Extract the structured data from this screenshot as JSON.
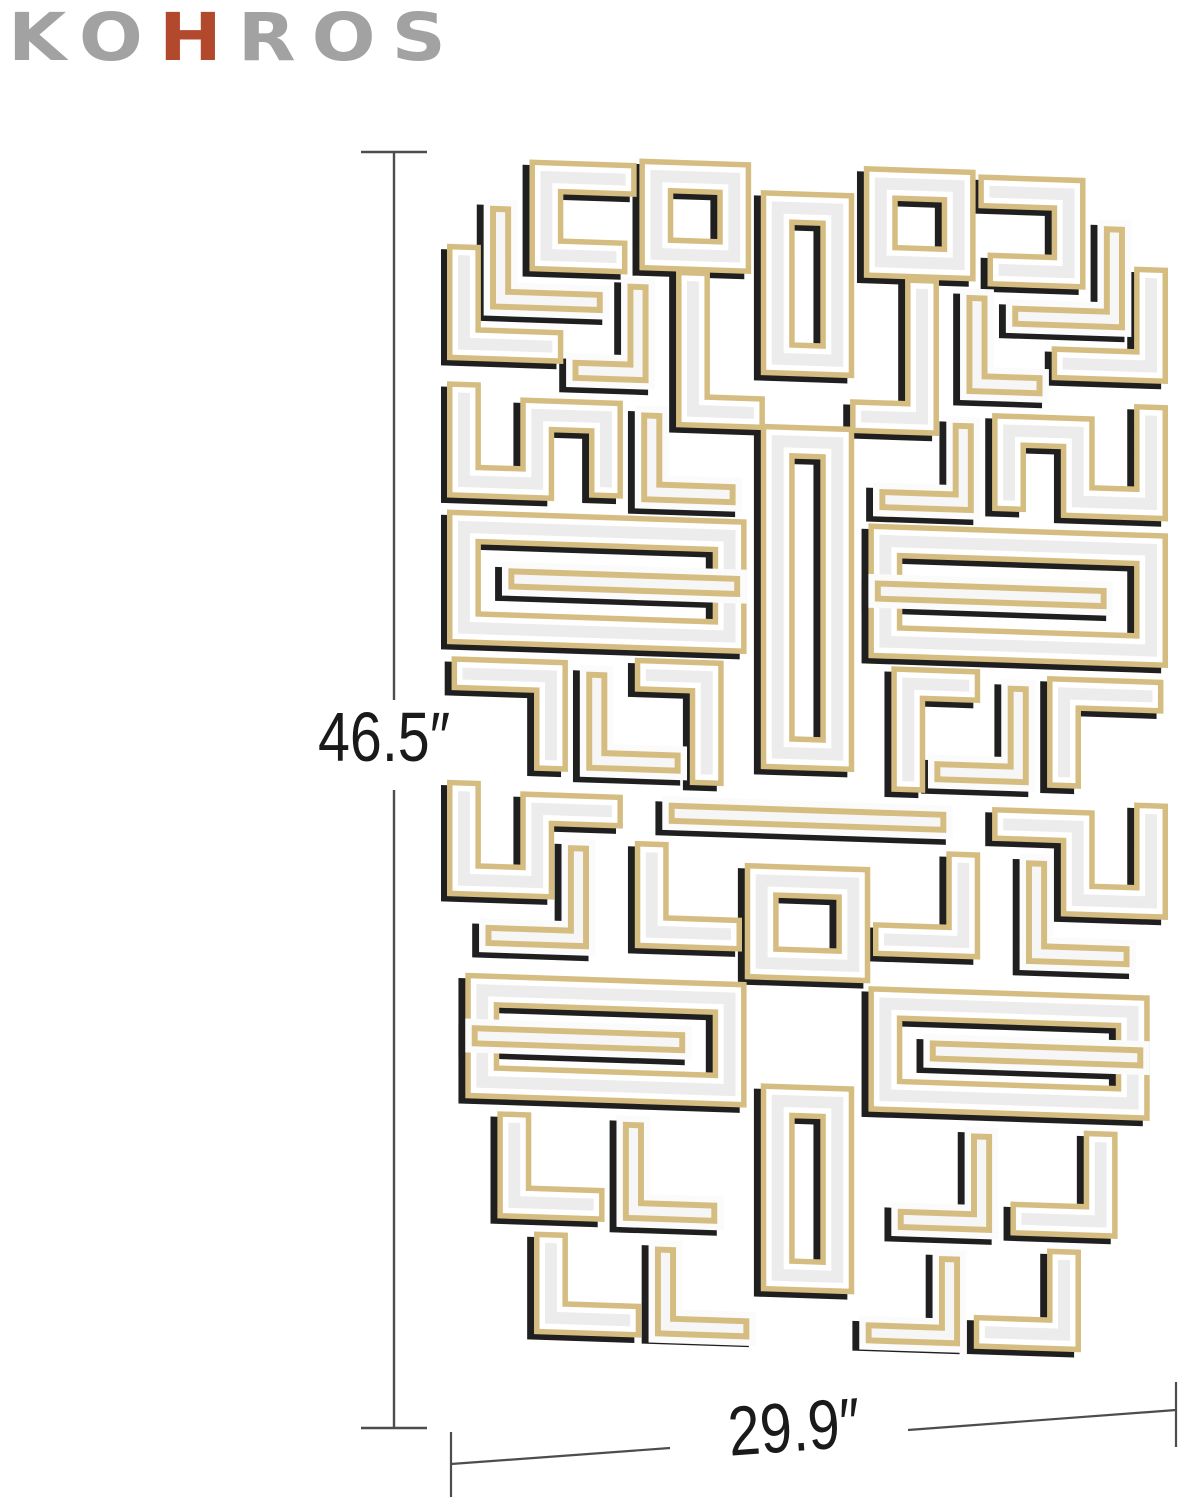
{
  "brand": {
    "letters": [
      {
        "ch": "K",
        "accent": false
      },
      {
        "ch": "O",
        "accent": false
      },
      {
        "ch": "H",
        "accent": true
      },
      {
        "ch": "R",
        "accent": false
      },
      {
        "ch": "O",
        "accent": false
      },
      {
        "ch": "S",
        "accent": false
      }
    ]
  },
  "dimensions": {
    "height_label": "46.5″",
    "width_label": "29.9″"
  },
  "colors": {
    "logo_gray": "#a2a2a2",
    "logo_red": "#b3492c",
    "gold": "#d5bd82",
    "bevel_white": "#ffffff",
    "bevel_white_b": "#fbfbfb",
    "mirror_face": "#ececec",
    "mirror_face_b": "#f6f6f6",
    "shadow": "#1f1f1f",
    "dim_line": "#4d4d4d",
    "label_text": "#1a1a1a"
  },
  "mirror": {
    "grid_w": 16,
    "grid_h": 26,
    "shadow_offset": [
      -0.15,
      0.12
    ],
    "layers": {
      "a": [
        [
          "gold",
          0.74
        ],
        [
          "bevel_white",
          0.5
        ],
        [
          "mirror_face",
          0.26
        ]
      ],
      "b": [
        [
          "bevel_white_b",
          0.74
        ],
        [
          "gold",
          0.46
        ],
        [
          "mirror_face_b",
          0.2
        ]
      ]
    },
    "strips_center": [
      {
        "v": "a",
        "ring": true,
        "pts": [
          [
            7.35,
            1.1
          ],
          [
            8.65,
            1.1
          ],
          [
            8.65,
            4.4
          ],
          [
            7.35,
            4.4
          ]
        ]
      },
      {
        "v": "a",
        "ring": true,
        "pts": [
          [
            7.35,
            6.2
          ],
          [
            8.65,
            6.2
          ],
          [
            8.65,
            13.0
          ],
          [
            7.35,
            13.0
          ]
        ]
      },
      {
        "v": "b",
        "ring": false,
        "pts": [
          [
            5.2,
            14.4
          ],
          [
            10.8,
            14.4
          ]
        ]
      },
      {
        "v": "a",
        "ring": true,
        "pts": [
          [
            7.0,
            15.8
          ],
          [
            9.0,
            15.8
          ],
          [
            9.0,
            17.6
          ],
          [
            7.0,
            17.6
          ]
        ]
      },
      {
        "v": "a",
        "ring": true,
        "pts": [
          [
            7.35,
            20.6
          ],
          [
            8.65,
            20.6
          ],
          [
            8.65,
            24.4
          ],
          [
            7.35,
            24.4
          ]
        ]
      }
    ],
    "strips_left": [
      {
        "v": "a",
        "ring": true,
        "pts": [
          [
            4.7,
            0.5
          ],
          [
            6.4,
            0.5
          ],
          [
            6.4,
            2.2
          ],
          [
            4.7,
            2.2
          ]
        ]
      },
      {
        "v": "a",
        "ring": false,
        "pts": [
          [
            3.9,
            0.6
          ],
          [
            2.3,
            0.6
          ],
          [
            2.3,
            2.3
          ],
          [
            3.7,
            2.3
          ]
        ]
      },
      {
        "v": "b",
        "ring": false,
        "pts": [
          [
            1.3,
            1.5
          ],
          [
            1.3,
            3.3
          ],
          [
            3.3,
            3.3
          ]
        ]
      },
      {
        "v": "a",
        "ring": false,
        "pts": [
          [
            0.5,
            2.5
          ],
          [
            0.5,
            4.3
          ],
          [
            2.3,
            4.3
          ]
        ]
      },
      {
        "v": "b",
        "ring": false,
        "pts": [
          [
            4.3,
            3.1
          ],
          [
            4.3,
            4.8
          ],
          [
            3.1,
            4.8
          ]
        ]
      },
      {
        "v": "a",
        "ring": false,
        "pts": [
          [
            5.5,
            2.9
          ],
          [
            5.5,
            5.6
          ],
          [
            6.7,
            5.6
          ]
        ]
      },
      {
        "v": "a",
        "ring": false,
        "pts": [
          [
            0.5,
            5.5
          ],
          [
            0.5,
            7.3
          ],
          [
            2.1,
            7.3
          ],
          [
            2.1,
            5.8
          ],
          [
            3.6,
            5.8
          ],
          [
            3.6,
            7.2
          ]
        ]
      },
      {
        "v": "b",
        "ring": false,
        "pts": [
          [
            4.6,
            5.9
          ],
          [
            4.6,
            7.4
          ],
          [
            6.2,
            7.4
          ]
        ]
      },
      {
        "v": "a",
        "ring": true,
        "pts": [
          [
            0.5,
            8.3
          ],
          [
            6.3,
            8.3
          ],
          [
            6.3,
            10.5
          ],
          [
            0.5,
            10.5
          ]
        ]
      },
      {
        "v": "b",
        "ring": false,
        "pts": [
          [
            6.3,
            9.4
          ],
          [
            1.7,
            9.4
          ]
        ]
      },
      {
        "v": "a",
        "ring": false,
        "pts": [
          [
            0.6,
            11.5
          ],
          [
            2.4,
            11.5
          ],
          [
            2.4,
            13.2
          ]
        ]
      },
      {
        "v": "b",
        "ring": false,
        "pts": [
          [
            3.4,
            11.6
          ],
          [
            3.4,
            13.3
          ],
          [
            5.0,
            13.3
          ]
        ]
      },
      {
        "v": "a",
        "ring": false,
        "pts": [
          [
            4.6,
            11.4
          ],
          [
            5.8,
            11.4
          ],
          [
            5.8,
            13.4
          ]
        ]
      },
      {
        "v": "a",
        "ring": false,
        "pts": [
          [
            0.5,
            14.2
          ],
          [
            0.5,
            16.0
          ],
          [
            2.1,
            16.0
          ],
          [
            2.1,
            14.4
          ],
          [
            3.6,
            14.4
          ]
        ]
      },
      {
        "v": "a",
        "ring": false,
        "pts": [
          [
            4.6,
            15.4
          ],
          [
            4.6,
            17.0
          ],
          [
            6.2,
            17.0
          ]
        ]
      },
      {
        "v": "b",
        "ring": false,
        "pts": [
          [
            1.2,
            17.2
          ],
          [
            3.0,
            17.2
          ],
          [
            3.0,
            15.4
          ]
        ]
      },
      {
        "v": "a",
        "ring": true,
        "pts": [
          [
            0.9,
            18.4
          ],
          [
            6.3,
            18.4
          ],
          [
            6.3,
            20.4
          ],
          [
            0.9,
            20.4
          ]
        ]
      },
      {
        "v": "b",
        "ring": false,
        "pts": [
          [
            0.9,
            19.4
          ],
          [
            5.1,
            19.4
          ]
        ]
      },
      {
        "v": "a",
        "ring": false,
        "pts": [
          [
            1.6,
            21.4
          ],
          [
            1.6,
            23.0
          ],
          [
            3.2,
            23.0
          ]
        ]
      },
      {
        "v": "b",
        "ring": false,
        "pts": [
          [
            4.2,
            21.4
          ],
          [
            4.2,
            23.1
          ],
          [
            5.8,
            23.1
          ]
        ]
      },
      {
        "v": "a",
        "ring": false,
        "pts": [
          [
            2.4,
            24.0
          ],
          [
            2.4,
            25.5
          ],
          [
            4.0,
            25.5
          ]
        ]
      },
      {
        "v": "b",
        "ring": false,
        "pts": [
          [
            4.9,
            24.1
          ],
          [
            4.9,
            25.6
          ],
          [
            6.5,
            25.6
          ]
        ]
      }
    ]
  },
  "dim_geometry": {
    "v_line": {
      "x": 394,
      "seg1": [
        153,
        700
      ],
      "seg2": [
        790,
        1428
      ],
      "cap_x1": 361,
      "cap_x2": 427,
      "cap_y_top": 152,
      "cap_y_bot": 1428
    },
    "h_line": {
      "seg1": [
        [
          451,
          1464
        ],
        [
          670,
          1448
        ]
      ],
      "seg2": [
        [
          908,
          1430
        ],
        [
          1176,
          1410
        ]
      ],
      "cap_left": [
        [
          451,
          1432
        ],
        [
          451,
          1497
        ]
      ],
      "cap_right": [
        [
          1176,
          1382
        ],
        [
          1176,
          1447
        ]
      ]
    }
  }
}
